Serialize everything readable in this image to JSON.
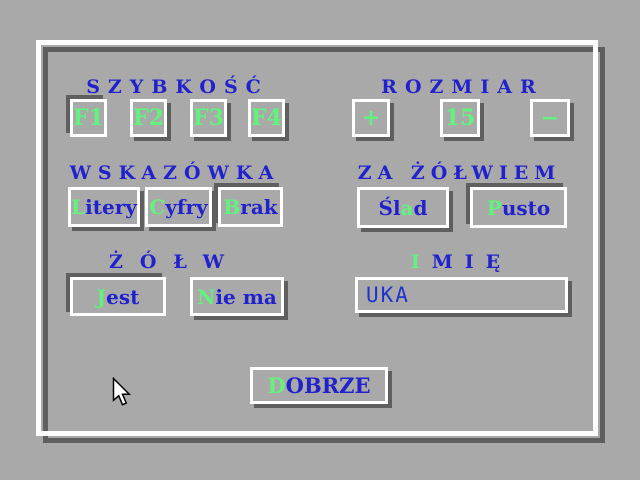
{
  "colors": {
    "background": "#a9a9a9",
    "bevel_highlight": "#ffffff",
    "bevel_shadow": "#5f5f5f",
    "label_blue": "#2222cc",
    "hotkey_green": "#63f27d"
  },
  "speed": {
    "heading": "SZYBKOŚĆ",
    "buttons": [
      {
        "label": "F1",
        "selected": true
      },
      {
        "label": "F2",
        "selected": false
      },
      {
        "label": "F3",
        "selected": false
      },
      {
        "label": "F4",
        "selected": false
      }
    ]
  },
  "size": {
    "heading": "ROZMIAR",
    "increase_label": "+",
    "value": "15",
    "decrease_label": "−"
  },
  "hint": {
    "heading": "WSKAZÓWKA",
    "buttons": [
      {
        "text": "Litery",
        "hot": 0,
        "selected": false
      },
      {
        "text": "Cyfry",
        "hot": 0,
        "selected": false
      },
      {
        "text": "Brak",
        "hot": 0,
        "selected": true
      }
    ]
  },
  "trail": {
    "heading": "ZA ŻÓŁWIEM",
    "buttons": [
      {
        "text": "Ślad",
        "hot": 2,
        "selected": false
      },
      {
        "text": "Pusto",
        "hot": 0,
        "selected": true
      }
    ]
  },
  "turtle": {
    "heading": "ŻÓŁW",
    "buttons": [
      {
        "text": "Jest",
        "hot": 0,
        "selected": true
      },
      {
        "text": "Nie ma",
        "hot": 0,
        "selected": false
      }
    ]
  },
  "name": {
    "heading": {
      "text": "IMIĘ",
      "hot": 0
    },
    "value": "UKA"
  },
  "ok_button": {
    "text": "DOBRZE",
    "hot": 0
  },
  "cursor": {
    "icon": "arrow-pointer"
  }
}
